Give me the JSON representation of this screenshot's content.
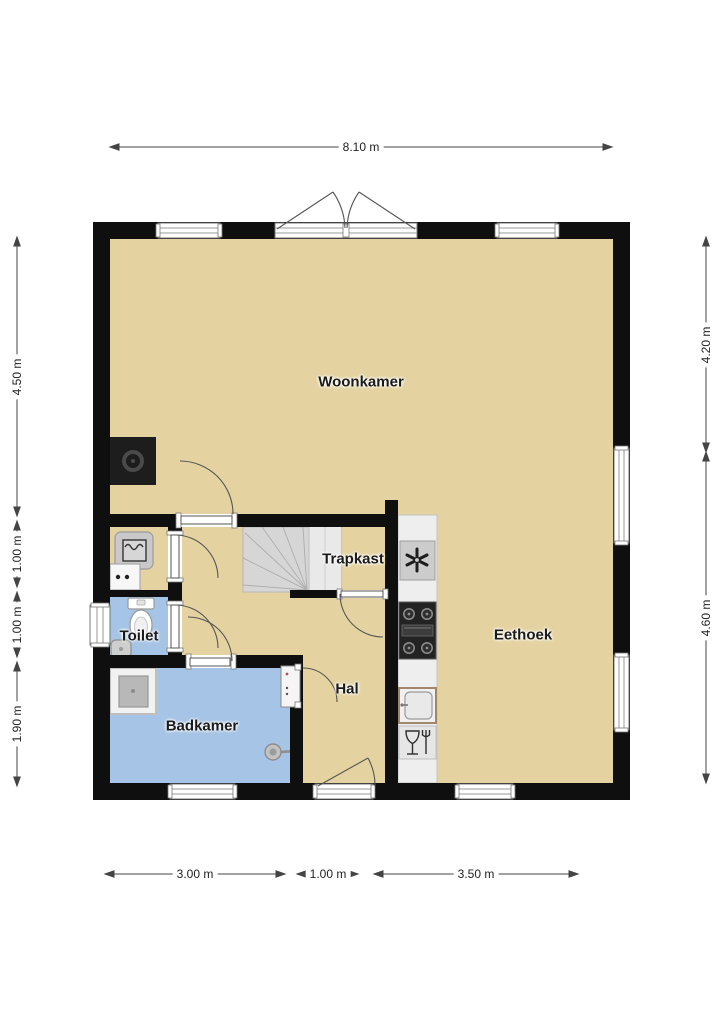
{
  "plan": {
    "type": "floor-plan",
    "unit": "m"
  },
  "rooms": [
    {
      "label": "Woonkamer"
    },
    {
      "label": "Trapkast"
    },
    {
      "label": "Eethoek"
    },
    {
      "label": "Toilet"
    },
    {
      "label": "Hal"
    },
    {
      "label": "Badkamer"
    }
  ],
  "dimensions": {
    "top": [
      {
        "label": "8.10 m"
      }
    ],
    "bottom": [
      {
        "label": "3.00 m"
      },
      {
        "label": "1.00 m"
      },
      {
        "label": "3.50 m"
      }
    ],
    "left": [
      {
        "label": "4.50 m"
      },
      {
        "label": "1.00 m"
      },
      {
        "label": "1.00 m"
      },
      {
        "label": "1.90 m"
      }
    ],
    "right": [
      {
        "label": "4.20 m"
      },
      {
        "label": "4.60 m"
      }
    ]
  },
  "fixtures": [
    "stairs-icon",
    "extractor-fan-icon",
    "stove-icon",
    "kitchen-sink-icon",
    "dishwasher-icon",
    "fireplace-icon",
    "toilet-icon",
    "hand-basin-icon",
    "washing-machine-icon",
    "laundry-tub-icon",
    "shower-icon",
    "shower-head-icon",
    "vanity-icon",
    "french-doors-icon",
    "front-door-icon",
    "window-icon",
    "door-icon"
  ],
  "colors": {
    "wall": "#0f0f0f",
    "floor_tan": "#e4d3a1",
    "wet_room_blue": "#a6c4e5",
    "stairs_gray": "#d6d6d6",
    "counter": "#eeeeee",
    "background": "#ffffff",
    "dimension_line": "#444444"
  }
}
